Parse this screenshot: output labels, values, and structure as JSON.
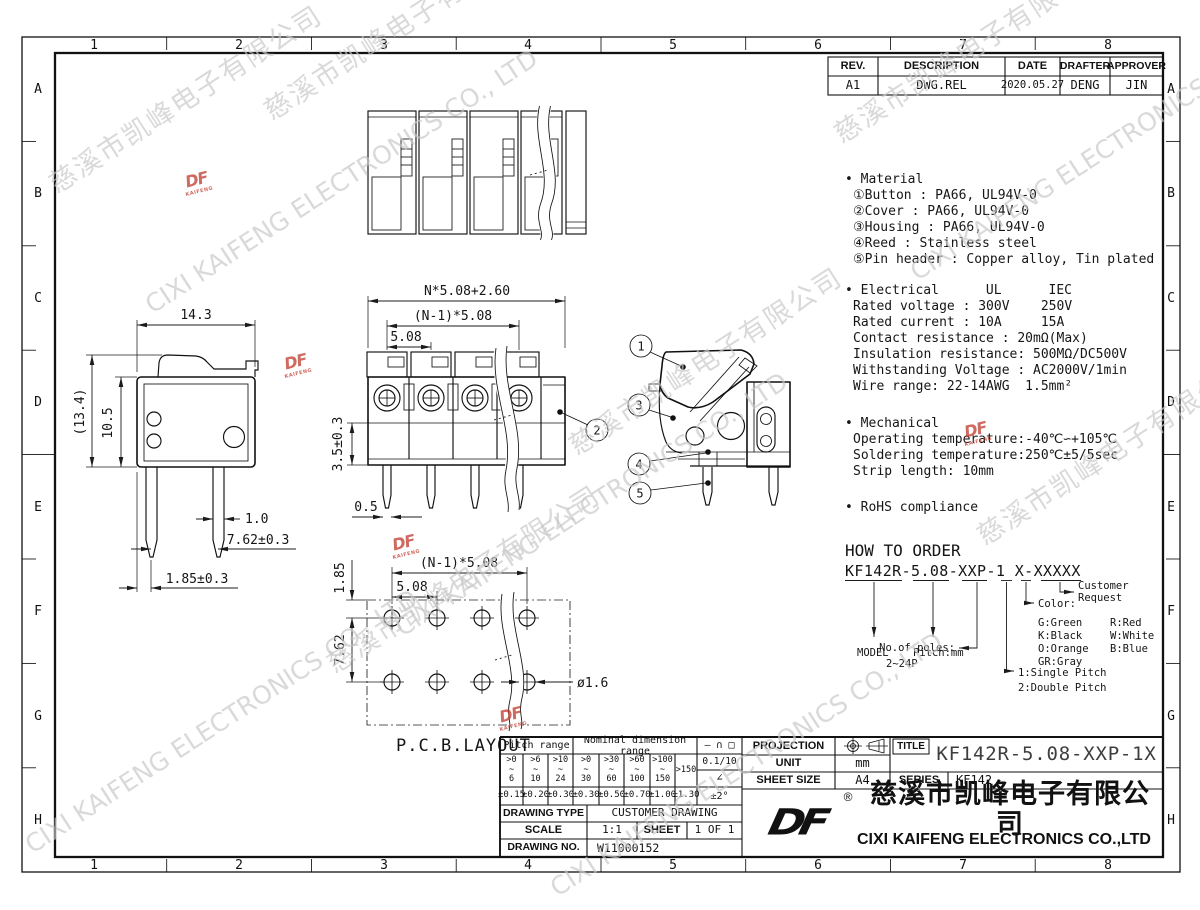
{
  "frame": {
    "cols": [
      "1",
      "2",
      "3",
      "4",
      "5",
      "6",
      "7",
      "8"
    ],
    "rows": [
      "A",
      "B",
      "C",
      "D",
      "E",
      "F",
      "G",
      "H"
    ]
  },
  "rev_table": {
    "headers": [
      "REV.",
      "DESCRIPTION",
      "DATE",
      "DRAFTER",
      "APPROVER"
    ],
    "row": [
      "A1",
      "DWG.REL",
      "2020.05.27",
      "DENG",
      "JIN"
    ]
  },
  "specs": {
    "material": {
      "lines": [
        "• Material",
        "①Button : PA66, UL94V-0",
        "②Cover : PA66, UL94V-0",
        "③Housing : PA66, UL94V-0",
        "④Reed : Stainless steel",
        "⑤Pin header : Copper alloy, Tin plated"
      ]
    },
    "electrical": {
      "lines": [
        "• Electrical      UL      IEC",
        "Rated voltage : 300V    250V",
        "Rated current : 10A     15A",
        "Contact resistance : 20mΩ(Max)",
        "Insulation resistance: 500MΩ/DC500V",
        "Withstanding Voltage : AC2000V/1min",
        "Wire range: 22-14AWG  1.5mm²"
      ]
    },
    "mechanical": {
      "lines": [
        "• Mechanical",
        "Operating temperature:-40℃∽+105℃",
        "Soldering temperature:250℃±5/5sec",
        "Strip length: 10mm"
      ]
    },
    "rohs": {
      "lines": [
        "• RoHS compliance"
      ]
    }
  },
  "how_to_order": {
    "title": "HOW TO ORDER",
    "code": "KF142R-5.08-XXP-1 X-XXXXX",
    "model": "MODEL",
    "pitch": "Pitch:mm",
    "poles_label": "No.of poles:",
    "poles_range": "2~24P",
    "single": "1:Single Pitch",
    "double": "2:Double Pitch",
    "color_label": "Color:",
    "colors": [
      "G:Green",
      "R:Red",
      "K:Black",
      "W:White",
      "O:Orange",
      "B:Blue",
      "GR:Gray"
    ],
    "customer1": "Customer",
    "customer2": "Request"
  },
  "dims": {
    "side": {
      "width": "14.3",
      "total_h": "(13.4)",
      "body_h": "10.5",
      "pin_w": "1.0",
      "pin_pitch": "7.62±0.3",
      "offset": "1.85±0.3"
    },
    "front": {
      "total_w": "N*5.08+2.60",
      "centers": "(N-1)*5.08",
      "pitch": "5.08",
      "mount_h": "3.5±0.3",
      "pin_w": "0.5"
    },
    "pcb": {
      "centers": "(N-1)*5.08",
      "pitch": "5.08",
      "row_off": "1.85",
      "row_pitch": "7.62",
      "hole": "ø1.6",
      "label": "P.C.B.LAYOUT"
    }
  },
  "balloons": [
    "1",
    "2",
    "3",
    "4",
    "5"
  ],
  "tol_table": {
    "pitch_header": "Pitch range",
    "nominal_header": "Nominal dimension range",
    "symbols": "— ∩ □",
    "ranges": [
      ">0\n~\n6",
      ">6\n~\n10",
      ">10\n~\n24",
      ">0\n~\n30",
      ">30\n~\n60",
      ">60\n~\n100",
      ">100\n~\n150",
      ">150"
    ],
    "tols": [
      "±0.15",
      "±0.20",
      "±0.30",
      "±0.30",
      "±0.50",
      "±0.70",
      "±1.00",
      "±1.30"
    ],
    "fine": "0.1/10",
    "angle_sym": "∠",
    "angle_tol": "±2°"
  },
  "title_block": {
    "projection": "PROJECTION",
    "unit": "UNIT",
    "unit_v": "mm",
    "sheet_size": "SHEET SIZE",
    "sheet_size_v": "A4",
    "series": "SERIES",
    "series_v": "KF142",
    "title_lbl": "TITLE",
    "title_v": "KF142R-5.08-XXP-1X",
    "dtype": "DRAWING TYPE",
    "dtype_v": "CUSTOMER DRAWING",
    "scale": "SCALE",
    "scale_v": "1:1",
    "sheet": "SHEET",
    "sheet_v": "1 OF 1",
    "dno": "DRAWING NO.",
    "dno_v": "W11000152"
  },
  "company": {
    "logo": "DF",
    "logo_sub": "KAIFENG",
    "reg": "®",
    "zh": "慈溪市凯峰电子有限公司",
    "en": "CIXI KAIFENG ELECTRONICS CO.,LTD"
  },
  "watermark": {
    "zh": "慈溪市凯峰电子有限公司",
    "en": "CIXI KAIFENG ELECTRONICS CO., LTD"
  }
}
